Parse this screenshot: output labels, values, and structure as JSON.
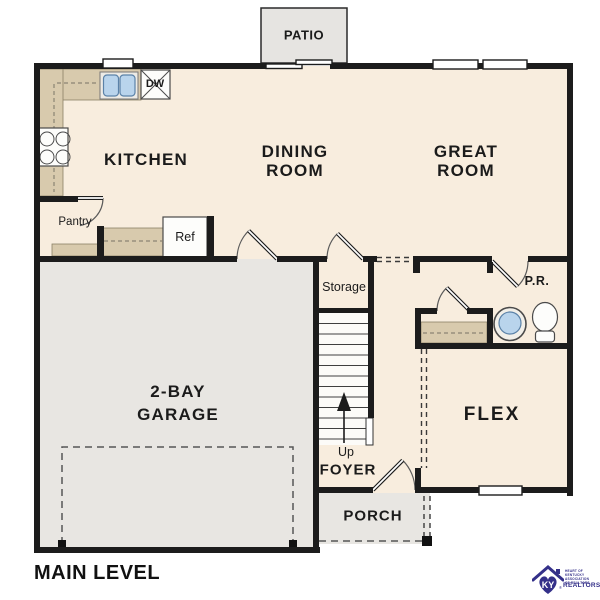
{
  "title": "MAIN LEVEL",
  "labels": {
    "patio": "PATIO",
    "kitchen": "KITCHEN",
    "dining1": "DINING",
    "dining2": "ROOM",
    "great1": "GREAT",
    "great2": "ROOM",
    "garage1": "2-BAY",
    "garage2": "GARAGE",
    "storage": "Storage",
    "powder": "P.R.",
    "flex": "FLEX",
    "up": "Up",
    "foyer": "FOYER",
    "porch": "PORCH",
    "pantry": "Pantry",
    "ref": "Ref",
    "dw": "DW"
  },
  "logo": {
    "monogram": "KY",
    "tagline": "HEART OF KENTUCKY ASSOCIATION OF REALTORS",
    "name": "REALTORS",
    "registered": "®"
  },
  "colors": {
    "wall": "#1c1c1c",
    "floor": "#f8edde",
    "garage": "#e8e6e2",
    "counter": "#d8caad",
    "sink": "#b9d4ec",
    "accent": "#343089"
  }
}
